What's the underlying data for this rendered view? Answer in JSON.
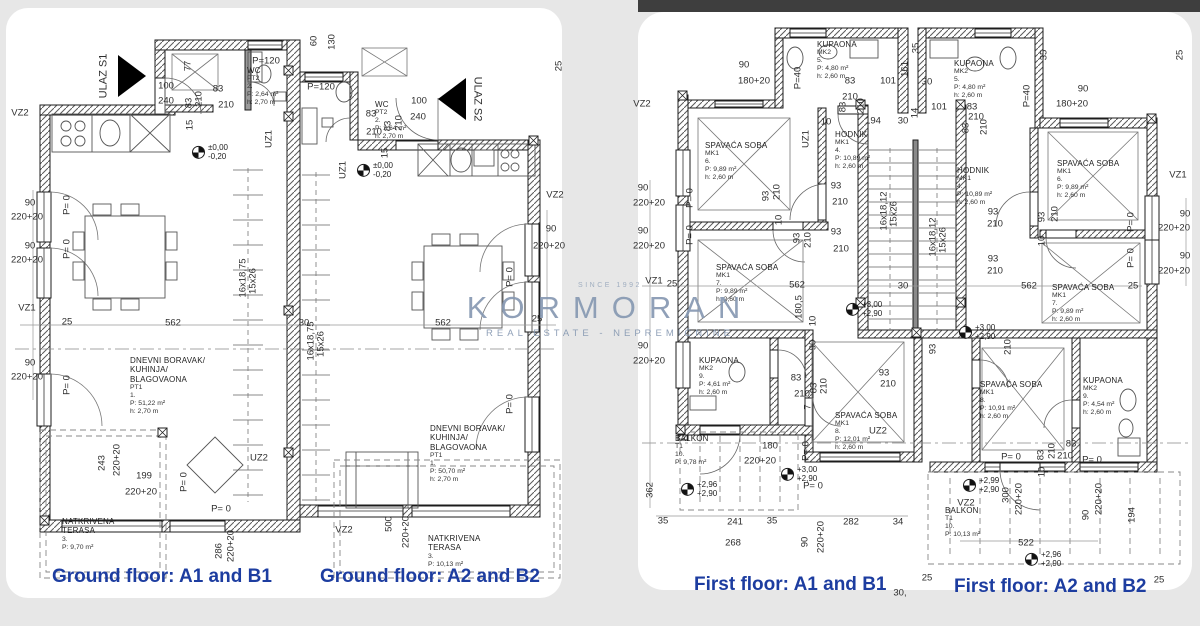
{
  "colors": {
    "caption_blue": "#1d3da0",
    "watermark_blue": "#8799b2",
    "wall_line": "#1c1c1c",
    "background": "#e7e7e7",
    "sheet": "#ffffff",
    "top_strip": "#3e3e3e"
  },
  "watermark": {
    "since": "SINCE 1992",
    "brand": "KORMORAN",
    "tagline": "REAL ESTATE - NEPREMIČNINE"
  },
  "captions": [
    {
      "text": "Ground floor: A1 and B1",
      "x": 52,
      "y": 566
    },
    {
      "text": "Ground floor: A2 and B2",
      "x": 320,
      "y": 566
    },
    {
      "text": "First floor: A1 and B1",
      "x": 694,
      "y": 574
    },
    {
      "text": "First floor: A2 and B2",
      "x": 954,
      "y": 576
    }
  ],
  "room_labels": [
    {
      "x": 130,
      "y": 356,
      "lines": [
        "DNEVNI BORAVAK/",
        "KUHINJA/",
        "BLAGOVAONA",
        "PT1",
        "1.",
        "P: 51,22 m²",
        "h: 2,70 m"
      ]
    },
    {
      "x": 430,
      "y": 424,
      "lines": [
        "DNEVNI BORAVAK/",
        "KUHINJA/",
        "BLAGOVAONA",
        "PT1",
        "1.",
        "P: 50,70 m²",
        "h: 2,70 m"
      ]
    },
    {
      "x": 62,
      "y": 517,
      "lines": [
        "NATKRIVENA",
        "TERASA",
        "3.",
        "P: 9,70 m²"
      ]
    },
    {
      "x": 428,
      "y": 534,
      "lines": [
        "NATKRIVENA",
        "TERASA",
        "3.",
        "P: 10,13 m²"
      ]
    },
    {
      "x": 247,
      "y": 66,
      "lines": [
        "WC",
        "PT2",
        "2.",
        "P: 2,64 m²",
        "h: 2,70 m"
      ]
    },
    {
      "x": 375,
      "y": 100,
      "lines": [
        "WC",
        "PT2",
        "2.",
        "P: 2,64 m²",
        "h: 2,70 m"
      ]
    },
    {
      "x": 817,
      "y": 40,
      "lines": [
        "KUPAONA",
        "MK2",
        "5.",
        "P: 4,80 m²",
        "h: 2,60 m"
      ]
    },
    {
      "x": 954,
      "y": 59,
      "lines": [
        "KUPAONA",
        "MK2",
        "5.",
        "P: 4,80 m²",
        "h: 2,60 m"
      ]
    },
    {
      "x": 705,
      "y": 141,
      "lines": [
        "SPAVAĆA SOBA",
        "MK1",
        "6.",
        "P: 9,89 m²",
        "h: 2,60 m"
      ]
    },
    {
      "x": 1057,
      "y": 159,
      "lines": [
        "SPAVAĆA SOBA",
        "MK1",
        "6.",
        "P: 9,89 m²",
        "h: 2,60 m"
      ]
    },
    {
      "x": 835,
      "y": 130,
      "lines": [
        "HODNIK",
        "MK1",
        "4.",
        "P: 10,89 m²",
        "h: 2,60 m"
      ]
    },
    {
      "x": 957,
      "y": 166,
      "lines": [
        "HODNIK",
        "MK1",
        "4.",
        "P: 10,89 m²",
        "h: 2,60 m"
      ]
    },
    {
      "x": 716,
      "y": 263,
      "lines": [
        "SPAVAĆA SOBA",
        "MK1",
        "7.",
        "P: 9,89 m²",
        "h: 2,60 m"
      ]
    },
    {
      "x": 1052,
      "y": 283,
      "lines": [
        "SPAVAĆA SOBA",
        "MK1",
        "7.",
        "P: 9,89 m²",
        "h: 2,60 m"
      ]
    },
    {
      "x": 699,
      "y": 356,
      "lines": [
        "KUPAONA",
        "MK2",
        "9.",
        "P: 4,61 m²",
        "h: 2,60 m"
      ]
    },
    {
      "x": 1083,
      "y": 376,
      "lines": [
        "KUPAONA",
        "MK2",
        "9.",
        "P: 4,54 m²",
        "h: 2,60 m"
      ]
    },
    {
      "x": 835,
      "y": 411,
      "lines": [
        "SPAVAĆA SOBA",
        "MK1",
        "8.",
        "P: 12,01 m²",
        "h: 2,60 m"
      ]
    },
    {
      "x": 980,
      "y": 380,
      "lines": [
        "SPAVAĆA SOBA",
        "MK1",
        "8.",
        "P: 10,91 m²",
        "h: 2,60 m"
      ]
    },
    {
      "x": 675,
      "y": 434,
      "lines": [
        "BALKON",
        "T1",
        "10.",
        "P: 9,78 m²"
      ]
    },
    {
      "x": 945,
      "y": 506,
      "lines": [
        "BALKON",
        "T1",
        "10.",
        "P: 10,13 m²"
      ]
    }
  ],
  "levels": [
    {
      "x": 192,
      "y": 152,
      "lines": [
        "±0,00",
        "-0,20"
      ]
    },
    {
      "x": 357,
      "y": 170,
      "lines": [
        "±0,00",
        "-0,20"
      ]
    },
    {
      "x": 846,
      "y": 309,
      "lines": [
        "+3,00",
        "+2,90"
      ]
    },
    {
      "x": 959,
      "y": 332,
      "lines": [
        "+3,00",
        "+2,90"
      ]
    },
    {
      "x": 781,
      "y": 474,
      "lines": [
        "+3,00",
        "+2,90"
      ]
    },
    {
      "x": 681,
      "y": 489,
      "lines": [
        "+2,96",
        "+2,90"
      ]
    },
    {
      "x": 963,
      "y": 485,
      "lines": [
        "+2,99",
        "+2,90"
      ]
    },
    {
      "x": 1025,
      "y": 559,
      "lines": [
        "+2,96",
        "+2,90"
      ]
    }
  ],
  "dims": [
    {
      "t": "VZ2",
      "x": 20,
      "y": 113
    },
    {
      "t": "100",
      "x": 166,
      "y": 86
    },
    {
      "t": "240",
      "x": 166,
      "y": 101
    },
    {
      "t": "83",
      "x": 218,
      "y": 89
    },
    {
      "t": "210",
      "x": 226,
      "y": 105
    },
    {
      "t": "77",
      "x": 188,
      "y": 66,
      "r": 1
    },
    {
      "t": "83",
      "x": 189,
      "y": 103,
      "r": 1
    },
    {
      "t": "210",
      "x": 199,
      "y": 99,
      "r": 1
    },
    {
      "t": "15",
      "x": 190,
      "y": 125,
      "r": 1
    },
    {
      "t": "P=120",
      "x": 266,
      "y": 61
    },
    {
      "t": "60",
      "x": 314,
      "y": 41,
      "r": 1
    },
    {
      "t": "130",
      "x": 332,
      "y": 42,
      "r": 1
    },
    {
      "t": "P=120",
      "x": 321,
      "y": 87
    },
    {
      "t": "100",
      "x": 419,
      "y": 101
    },
    {
      "t": "240",
      "x": 418,
      "y": 117
    },
    {
      "t": "83",
      "x": 371,
      "y": 114
    },
    {
      "t": "210",
      "x": 374,
      "y": 132
    },
    {
      "t": "83",
      "x": 388,
      "y": 126,
      "r": 1
    },
    {
      "t": "210",
      "x": 399,
      "y": 123,
      "r": 1
    },
    {
      "t": "15",
      "x": 385,
      "y": 153,
      "r": 1
    },
    {
      "t": "UZ1",
      "x": 269,
      "y": 139,
      "r": 1
    },
    {
      "t": "UZ1",
      "x": 343,
      "y": 170,
      "r": 1
    },
    {
      "t": "25",
      "x": 559,
      "y": 66,
      "r": 1
    },
    {
      "t": "90",
      "x": 30,
      "y": 203
    },
    {
      "t": "220+20",
      "x": 27,
      "y": 217
    },
    {
      "t": "90",
      "x": 30,
      "y": 246
    },
    {
      "t": "220+20",
      "x": 27,
      "y": 260
    },
    {
      "t": "VZ1",
      "x": 27,
      "y": 308
    },
    {
      "t": "25",
      "x": 67,
      "y": 322
    },
    {
      "t": "90",
      "x": 30,
      "y": 363
    },
    {
      "t": "220+20",
      "x": 27,
      "y": 377
    },
    {
      "t": "562",
      "x": 173,
      "y": 323
    },
    {
      "t": "30",
      "x": 304,
      "y": 323
    },
    {
      "t": "562",
      "x": 443,
      "y": 323
    },
    {
      "t": "25",
      "x": 537,
      "y": 319
    },
    {
      "t": "90",
      "x": 551,
      "y": 229
    },
    {
      "t": "220+20",
      "x": 549,
      "y": 246
    },
    {
      "t": "VZ2",
      "x": 555,
      "y": 195
    },
    {
      "t": "243",
      "x": 102,
      "y": 463,
      "r": 1
    },
    {
      "t": "220+20",
      "x": 117,
      "y": 460,
      "r": 1
    },
    {
      "t": "199",
      "x": 144,
      "y": 476
    },
    {
      "t": "220+20",
      "x": 141,
      "y": 492
    },
    {
      "t": "286",
      "x": 219,
      "y": 551,
      "r": 1
    },
    {
      "t": "220+20",
      "x": 231,
      "y": 546,
      "r": 1
    },
    {
      "t": "500",
      "x": 389,
      "y": 524,
      "r": 1
    },
    {
      "t": "220+20",
      "x": 406,
      "y": 532,
      "r": 1
    },
    {
      "t": "VZ2",
      "x": 344,
      "y": 530
    },
    {
      "t": "16x18,75",
      "x": 243,
      "y": 278,
      "r": 1
    },
    {
      "t": "15x26",
      "x": 253,
      "y": 281,
      "r": 1
    },
    {
      "t": "16x18,75",
      "x": 311,
      "y": 341,
      "r": 1
    },
    {
      "t": "15x26",
      "x": 321,
      "y": 344,
      "r": 1
    },
    {
      "t": "UZ2",
      "x": 259,
      "y": 458
    },
    {
      "t": "P= 0",
      "x": 67,
      "y": 205,
      "r": 1
    },
    {
      "t": "P= 0",
      "x": 67,
      "y": 249,
      "r": 1
    },
    {
      "t": "P= 0",
      "x": 67,
      "y": 385,
      "r": 1
    },
    {
      "t": "P= 0",
      "x": 184,
      "y": 482,
      "r": 1
    },
    {
      "t": "P= 0",
      "x": 221,
      "y": 509
    },
    {
      "t": "P= 0",
      "x": 510,
      "y": 277,
      "r": 1
    },
    {
      "t": "P= 0",
      "x": 510,
      "y": 404,
      "r": 1
    },
    {
      "t": "ULAZ S1",
      "x": 104,
      "y": 76,
      "r": 1,
      "s": 11
    },
    {
      "t": "ULAZ S2",
      "x": 477,
      "y": 99,
      "r": 2,
      "s": 11
    },
    {
      "t": "VZ2",
      "x": 642,
      "y": 104
    },
    {
      "t": "90",
      "x": 744,
      "y": 65
    },
    {
      "t": "180+20",
      "x": 754,
      "y": 81
    },
    {
      "t": "35",
      "x": 916,
      "y": 48,
      "r": 1
    },
    {
      "t": "161",
      "x": 905,
      "y": 69,
      "r": 1
    },
    {
      "t": "101",
      "x": 888,
      "y": 81
    },
    {
      "t": "83",
      "x": 850,
      "y": 81
    },
    {
      "t": "210",
      "x": 850,
      "y": 97
    },
    {
      "t": "83",
      "x": 843,
      "y": 107,
      "r": 1
    },
    {
      "t": "210",
      "x": 861,
      "y": 106,
      "r": 1
    },
    {
      "t": "14",
      "x": 915,
      "y": 113,
      "r": 1
    },
    {
      "t": "194",
      "x": 873,
      "y": 121
    },
    {
      "t": "10",
      "x": 826,
      "y": 122
    },
    {
      "t": "30",
      "x": 903,
      "y": 121
    },
    {
      "t": "P=40",
      "x": 798,
      "y": 78,
      "r": 1
    },
    {
      "t": "UZ1",
      "x": 806,
      "y": 139,
      "r": 1
    },
    {
      "t": "90",
      "x": 643,
      "y": 188
    },
    {
      "t": "220+20",
      "x": 649,
      "y": 203
    },
    {
      "t": "90",
      "x": 643,
      "y": 231
    },
    {
      "t": "220+20",
      "x": 649,
      "y": 246
    },
    {
      "t": "VZ1",
      "x": 654,
      "y": 281
    },
    {
      "t": "25",
      "x": 672,
      "y": 284
    },
    {
      "t": "90",
      "x": 643,
      "y": 346
    },
    {
      "t": "220+20",
      "x": 649,
      "y": 361
    },
    {
      "t": "362",
      "x": 650,
      "y": 490,
      "r": 1
    },
    {
      "t": "93",
      "x": 766,
      "y": 196,
      "r": 1
    },
    {
      "t": "210",
      "x": 777,
      "y": 192,
      "r": 1
    },
    {
      "t": "93",
      "x": 836,
      "y": 186
    },
    {
      "t": "210",
      "x": 840,
      "y": 202
    },
    {
      "t": "10",
      "x": 779,
      "y": 220,
      "r": 1
    },
    {
      "t": "93",
      "x": 797,
      "y": 238,
      "r": 1
    },
    {
      "t": "210",
      "x": 808,
      "y": 240,
      "r": 1
    },
    {
      "t": "93",
      "x": 836,
      "y": 232
    },
    {
      "t": "210",
      "x": 841,
      "y": 249
    },
    {
      "t": "562",
      "x": 797,
      "y": 285
    },
    {
      "t": "30",
      "x": 903,
      "y": 286
    },
    {
      "t": "180,5",
      "x": 799,
      "y": 307,
      "r": 1
    },
    {
      "t": "10",
      "x": 813,
      "y": 321,
      "r": 1
    },
    {
      "t": "90",
      "x": 813,
      "y": 345,
      "r": 1
    },
    {
      "t": "16x18,12",
      "x": 884,
      "y": 211,
      "r": 1
    },
    {
      "t": "15x26",
      "x": 894,
      "y": 214,
      "r": 1
    },
    {
      "t": "16x18,12",
      "x": 933,
      "y": 237,
      "r": 1
    },
    {
      "t": "15x26",
      "x": 943,
      "y": 240,
      "r": 1
    },
    {
      "t": "93",
      "x": 884,
      "y": 373
    },
    {
      "t": "210",
      "x": 888,
      "y": 384
    },
    {
      "t": "83",
      "x": 796,
      "y": 378
    },
    {
      "t": "210",
      "x": 802,
      "y": 394
    },
    {
      "t": "83",
      "x": 814,
      "y": 388,
      "r": 1
    },
    {
      "t": "210",
      "x": 824,
      "y": 386,
      "r": 1
    },
    {
      "t": "7",
      "x": 808,
      "y": 407,
      "r": 1
    },
    {
      "t": "180",
      "x": 770,
      "y": 446
    },
    {
      "t": "220+20",
      "x": 760,
      "y": 461
    },
    {
      "t": "P= 0",
      "x": 806,
      "y": 451,
      "r": 1
    },
    {
      "t": "P= 0",
      "x": 813,
      "y": 486
    },
    {
      "t": "UZ2",
      "x": 878,
      "y": 431
    },
    {
      "t": "35",
      "x": 663,
      "y": 521
    },
    {
      "t": "241",
      "x": 735,
      "y": 522
    },
    {
      "t": "35",
      "x": 772,
      "y": 521
    },
    {
      "t": "282",
      "x": 851,
      "y": 522
    },
    {
      "t": "34",
      "x": 898,
      "y": 522
    },
    {
      "t": "268",
      "x": 733,
      "y": 543
    },
    {
      "t": "90",
      "x": 805,
      "y": 542,
      "r": 1
    },
    {
      "t": "220+20",
      "x": 821,
      "y": 537,
      "r": 1
    },
    {
      "t": "30,",
      "x": 900,
      "y": 593
    },
    {
      "t": "25",
      "x": 927,
      "y": 578
    },
    {
      "t": "P= 0",
      "x": 690,
      "y": 198,
      "r": 1
    },
    {
      "t": "P= 0",
      "x": 690,
      "y": 235,
      "r": 1
    },
    {
      "t": "30",
      "x": 927,
      "y": 82
    },
    {
      "t": "101",
      "x": 939,
      "y": 107
    },
    {
      "t": "83",
      "x": 972,
      "y": 107
    },
    {
      "t": "210",
      "x": 976,
      "y": 117
    },
    {
      "t": "83",
      "x": 966,
      "y": 128,
      "r": 1
    },
    {
      "t": "210",
      "x": 984,
      "y": 127,
      "r": 1
    },
    {
      "t": "P=40",
      "x": 1027,
      "y": 96,
      "r": 1
    },
    {
      "t": "90",
      "x": 1083,
      "y": 89
    },
    {
      "t": "180+20",
      "x": 1072,
      "y": 104
    },
    {
      "t": "35",
      "x": 1044,
      "y": 55,
      "r": 1
    },
    {
      "t": "25",
      "x": 1180,
      "y": 55,
      "r": 1
    },
    {
      "t": "90",
      "x": 1185,
      "y": 214
    },
    {
      "t": "220+20",
      "x": 1174,
      "y": 228
    },
    {
      "t": "90",
      "x": 1185,
      "y": 256
    },
    {
      "t": "220+20",
      "x": 1174,
      "y": 271
    },
    {
      "t": "VZ1",
      "x": 1178,
      "y": 175
    },
    {
      "t": "25",
      "x": 1133,
      "y": 286
    },
    {
      "t": "93",
      "x": 993,
      "y": 212
    },
    {
      "t": "210",
      "x": 995,
      "y": 224
    },
    {
      "t": "93",
      "x": 993,
      "y": 259
    },
    {
      "t": "210",
      "x": 995,
      "y": 271
    },
    {
      "t": "93",
      "x": 1042,
      "y": 217,
      "r": 1
    },
    {
      "t": "210",
      "x": 1055,
      "y": 214,
      "r": 1
    },
    {
      "t": "10",
      "x": 1042,
      "y": 241,
      "r": 1
    },
    {
      "t": "562",
      "x": 1029,
      "y": 286
    },
    {
      "t": "93",
      "x": 933,
      "y": 349,
      "r": 1
    },
    {
      "t": "210",
      "x": 1008,
      "y": 347,
      "r": 1
    },
    {
      "t": "83",
      "x": 1071,
      "y": 444
    },
    {
      "t": "210",
      "x": 1065,
      "y": 456
    },
    {
      "t": "83",
      "x": 1041,
      "y": 455,
      "r": 1
    },
    {
      "t": "210",
      "x": 1052,
      "y": 451,
      "r": 1
    },
    {
      "t": "P= 0",
      "x": 1011,
      "y": 457
    },
    {
      "t": "P= 0",
      "x": 1092,
      "y": 460
    },
    {
      "t": "10",
      "x": 1042,
      "y": 472,
      "r": 1
    },
    {
      "t": "300",
      "x": 1006,
      "y": 495,
      "r": 1
    },
    {
      "t": "220+20",
      "x": 1019,
      "y": 499,
      "r": 1
    },
    {
      "t": "90",
      "x": 1086,
      "y": 515,
      "r": 1
    },
    {
      "t": "220+20",
      "x": 1099,
      "y": 499,
      "r": 1
    },
    {
      "t": "194",
      "x": 1132,
      "y": 515,
      "r": 1
    },
    {
      "t": "VZ2",
      "x": 966,
      "y": 503
    },
    {
      "t": "522",
      "x": 1026,
      "y": 543
    },
    {
      "t": "25",
      "x": 1159,
      "y": 580
    },
    {
      "t": "P= 0",
      "x": 1131,
      "y": 222,
      "r": 1
    },
    {
      "t": "P= 0",
      "x": 1131,
      "y": 258,
      "r": 1
    }
  ]
}
